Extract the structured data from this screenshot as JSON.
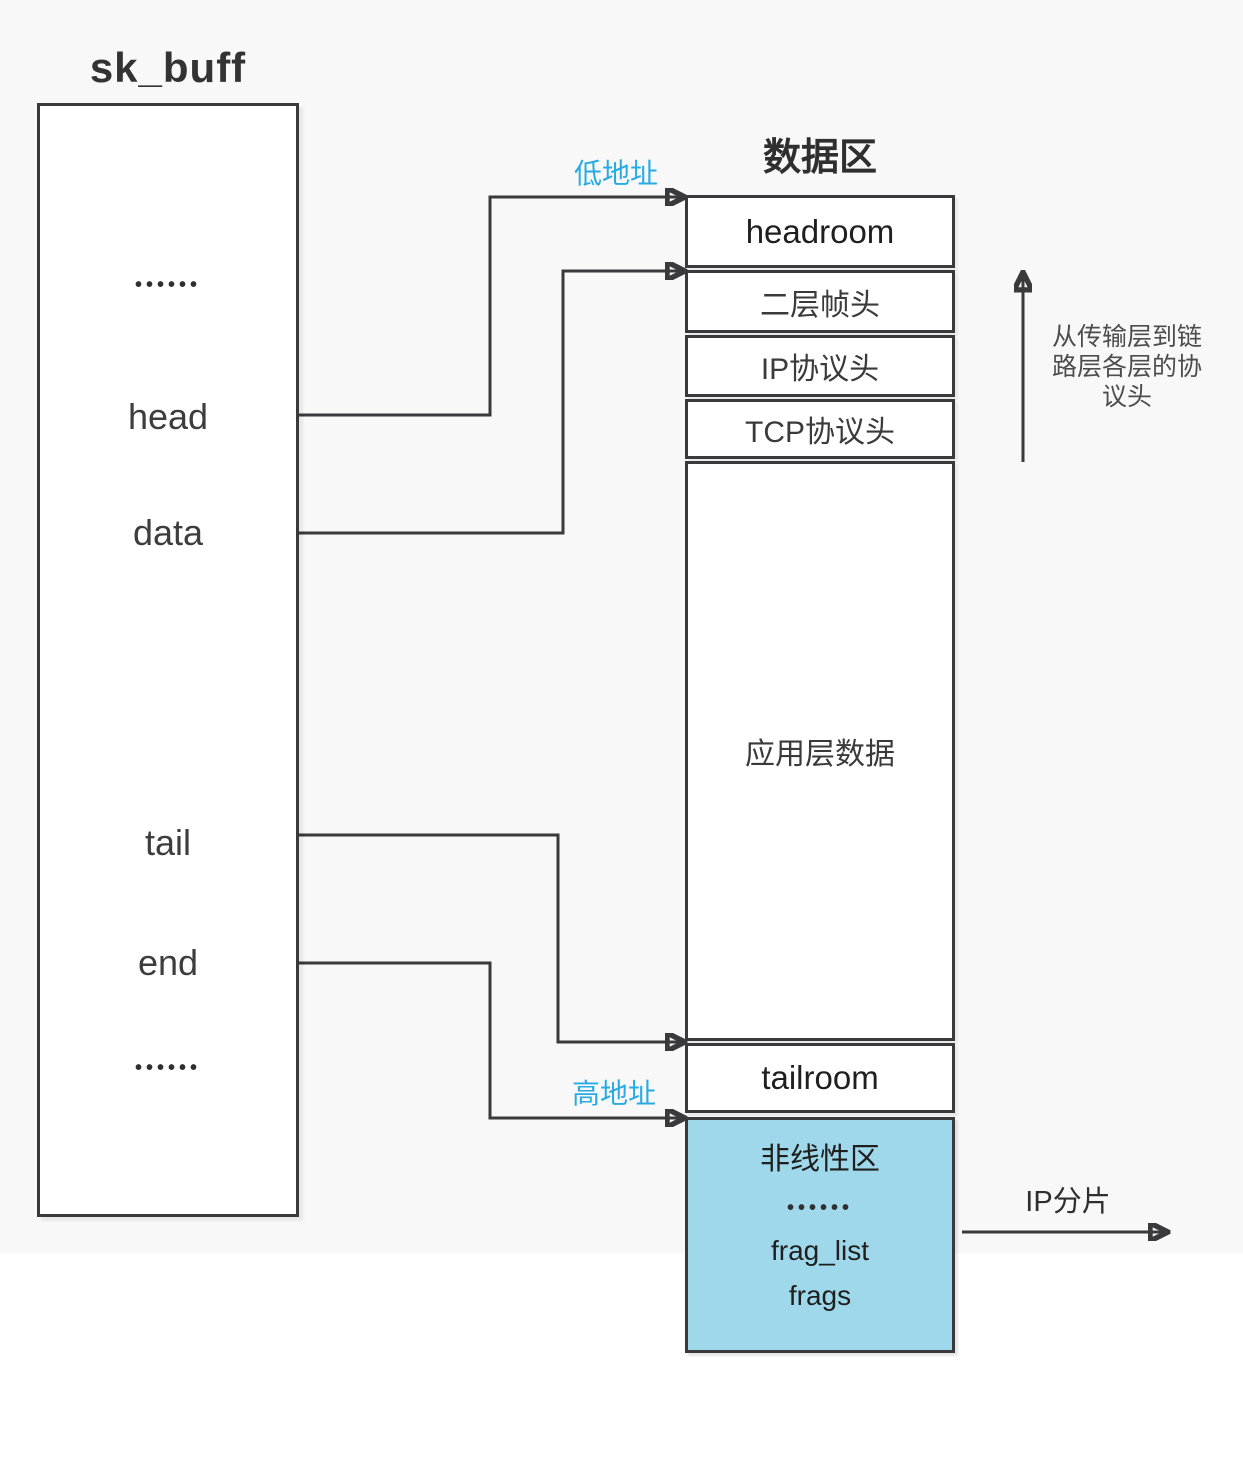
{
  "colors": {
    "canvas": "#f8f8f8",
    "line": "#3a3a3c",
    "accent": "#29abe2",
    "nonlinear_fill": "#9ed8ea",
    "note_text": "#4d4d4d"
  },
  "skbuff": {
    "title": "sk_buff",
    "fields": [
      "••••••",
      "head",
      "data",
      "tail",
      "end",
      "••••••"
    ]
  },
  "data_area": {
    "title": "数据区",
    "rows": [
      "headroom",
      "二层帧头",
      "IP协议头",
      "TCP协议头",
      "应用层数据",
      "tailroom"
    ],
    "nonlinear": {
      "title": "非线性区",
      "dots": "••••••",
      "items": [
        "frag_list",
        "frags"
      ]
    }
  },
  "annotations": {
    "low_address": "低地址",
    "high_address": "高地址",
    "protocol_note": "从传输层到链\n路层各层的协\n议头",
    "ip_fragment": "IP分片"
  }
}
